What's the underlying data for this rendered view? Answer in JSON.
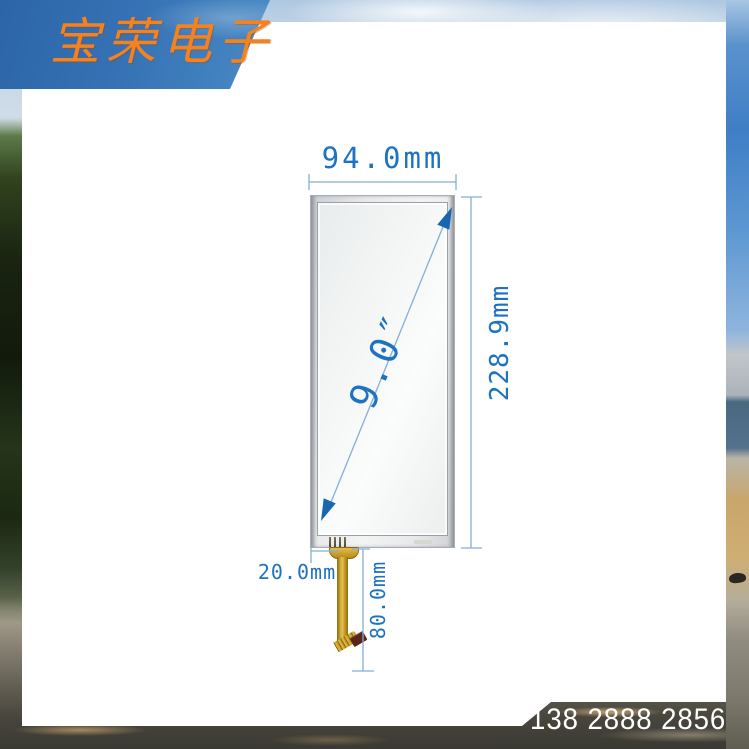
{
  "banner": {
    "company_name": "宝荣电子",
    "bg_color": "#3571b4",
    "text_color": "#f5811f"
  },
  "footer": {
    "phone_number": "138 2888 2856"
  },
  "diagram": {
    "labels": {
      "width": "94.0mm",
      "height": "228.9mm",
      "diagonal": "9.0″",
      "fpc_offset": "20.0mm",
      "fpc_length": "80.0mm"
    },
    "colors": {
      "dimension_text": "#1d72c2",
      "dimension_line": "#85aed6",
      "arrow_fill": "#1767b0",
      "panel_frame": "#e7e9ea",
      "fpc_gold": "#c89a28",
      "fpc_connector_brown": "#5c241a"
    }
  }
}
